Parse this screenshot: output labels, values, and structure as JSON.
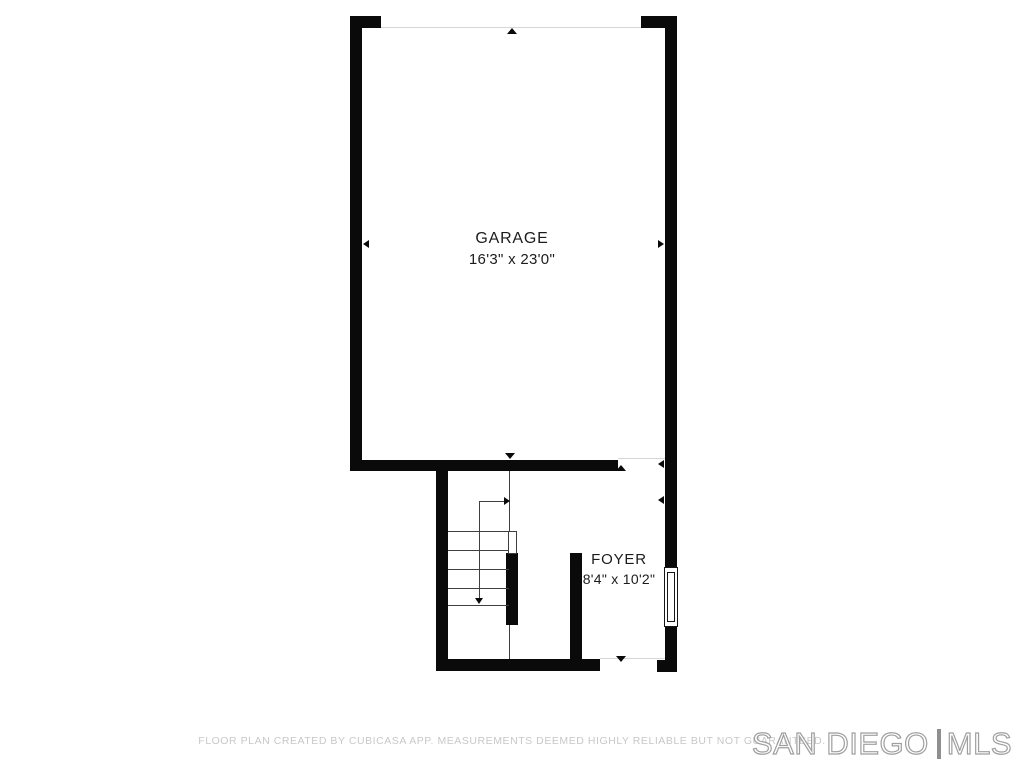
{
  "rooms": {
    "garage": {
      "name": "GARAGE",
      "dimensions": "16'3\" x 23'0\""
    },
    "foyer": {
      "name": "FOYER",
      "dimensions": "8'4\" x 10'2\""
    }
  },
  "footer": {
    "disclaimer": "FLOOR PLAN CREATED BY CUBICASA APP. MEASUREMENTS DEEMED HIGHLY RELIABLE BUT NOT GUARANTEED."
  },
  "logo": {
    "primary": "SAN DIEGO",
    "secondary": "MLS"
  },
  "colors": {
    "background": "#ffffff",
    "wall": "#0a0a0a",
    "stair_line": "#3f3f3f",
    "opening_line": "#d6d6d6",
    "footer_text": "#c8c8c8",
    "logo_outline": "#9f9f9f",
    "logo_divider": "#8f8f8f"
  }
}
